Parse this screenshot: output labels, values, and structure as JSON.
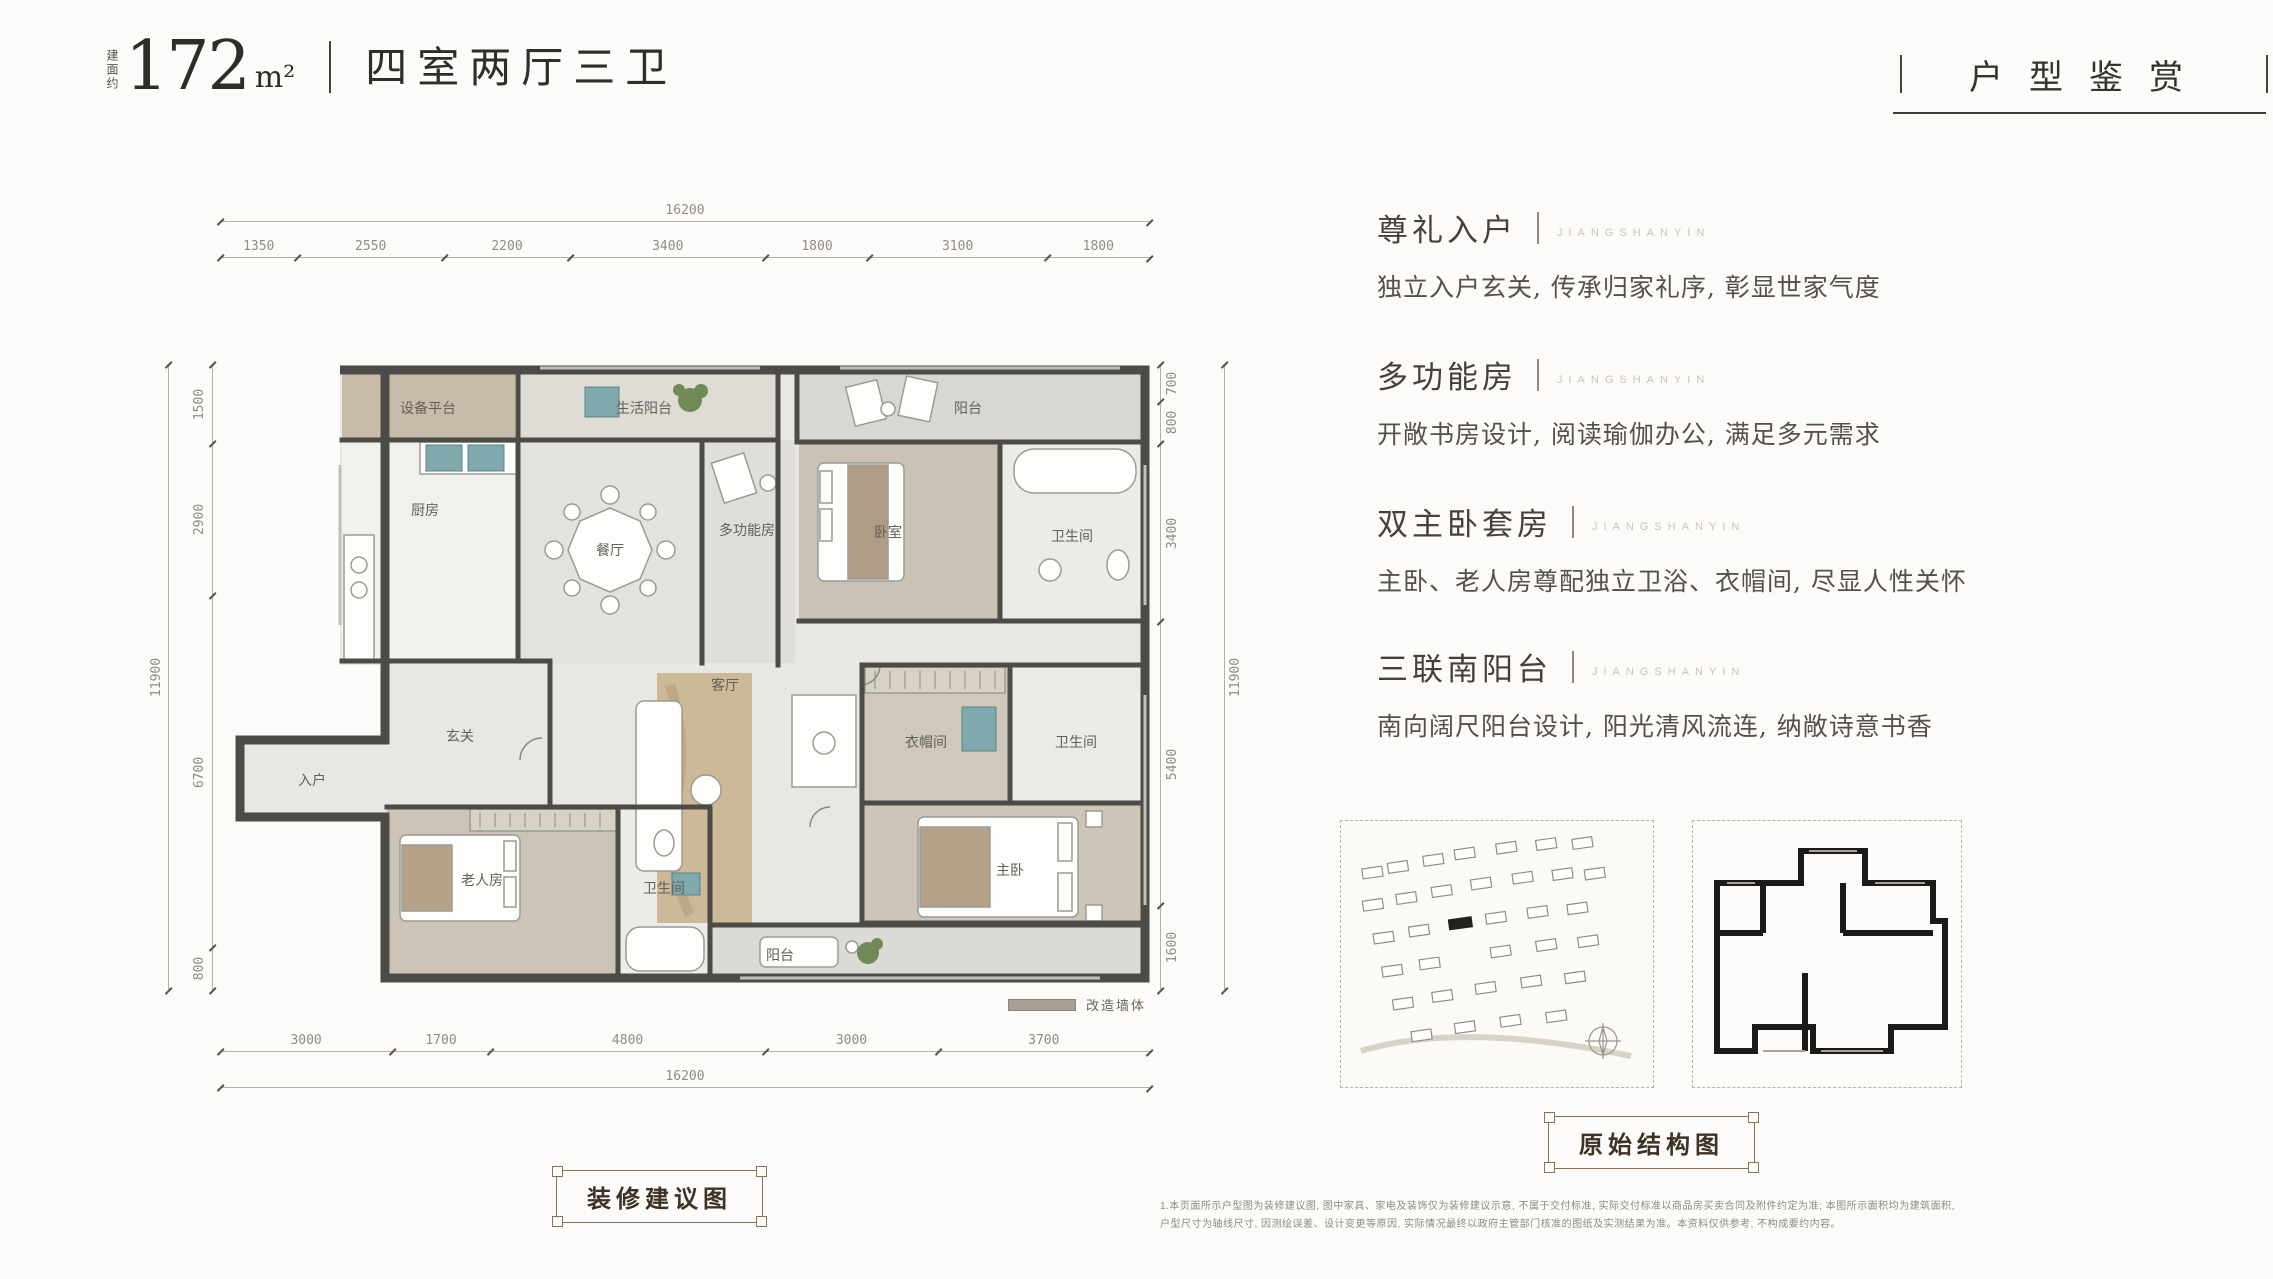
{
  "header": {
    "area_prefix": "建面约",
    "area_value": "172",
    "area_unit": "m²",
    "layout_name": "四室两厅三卫",
    "page_title": "户型鉴赏"
  },
  "features": [
    {
      "title": "尊礼入户",
      "latin": "JIANGSHANYIN",
      "desc": "独立入户玄关, 传承归家礼序, 彰显世家气度"
    },
    {
      "title": "多功能房",
      "latin": "JIANGSHANYIN",
      "desc": "开敞书房设计, 阅读瑜伽办公, 满足多元需求"
    },
    {
      "title": "双主卧套房",
      "latin": "JIANGSHANYIN",
      "desc": "主卧、老人房尊配独立卫浴、衣帽间, 尽显人性关怀"
    },
    {
      "title": "三联南阳台",
      "latin": "JIANGSHANYIN",
      "desc": "南向阔尺阳台设计, 阳光清风流连, 纳敞诗意书香"
    }
  ],
  "plan": {
    "caption": "装修建议图",
    "legend": "改造墙体",
    "dims_top": {
      "overall": "16200",
      "segments": [
        "1350",
        "2550",
        "2200",
        "3400",
        "1800",
        "3100",
        "1800"
      ]
    },
    "dims_bottom": {
      "overall": "16200",
      "segments": [
        "3000",
        "1700",
        "4800",
        "3000",
        "3700"
      ]
    },
    "dims_left": {
      "overall": "11900",
      "segments": [
        "1500",
        "2900",
        "6700",
        "800"
      ]
    },
    "dims_right": {
      "overall": "11900",
      "segments": [
        "700",
        "800",
        "3400",
        "5400",
        "1600"
      ]
    },
    "rooms": {
      "equipment_platform": "设备平台",
      "service_balcony": "生活阳台",
      "kitchen": "厨房",
      "dining": "餐厅",
      "study": "多功能房",
      "suite_balcony": "阳台",
      "bedroom2": "卧室",
      "bath2": "卫生间",
      "foyer": "玄关",
      "entry": "入户",
      "living": "客厅",
      "elder_room": "老人房",
      "bath3": "卫生间",
      "closet": "衣帽间",
      "master_bath": "卫生间",
      "master": "主卧",
      "south_balcony": "阳台"
    }
  },
  "original_plan": {
    "caption": "原始结构图"
  },
  "colors": {
    "accent_brown": "#8a7355",
    "wall": "#4d4b47",
    "teal_fixture": "#7fa9ad"
  },
  "disclaimer": [
    "1.本页面所示户型图为装修建议图, 图中家具、家电及装饰仅为装修建议示意, 不属于交付标准, 实际交付标准以商品房买卖合同及附件约定为准; 本图所示面积均为建筑面积,",
    "户型尺寸为轴线尺寸, 因测绘误差、设计变更等原因, 实际情况最终以政府主管部门核准的图纸及实测结果为准。本资料仅供参考, 不构成要约内容。"
  ]
}
